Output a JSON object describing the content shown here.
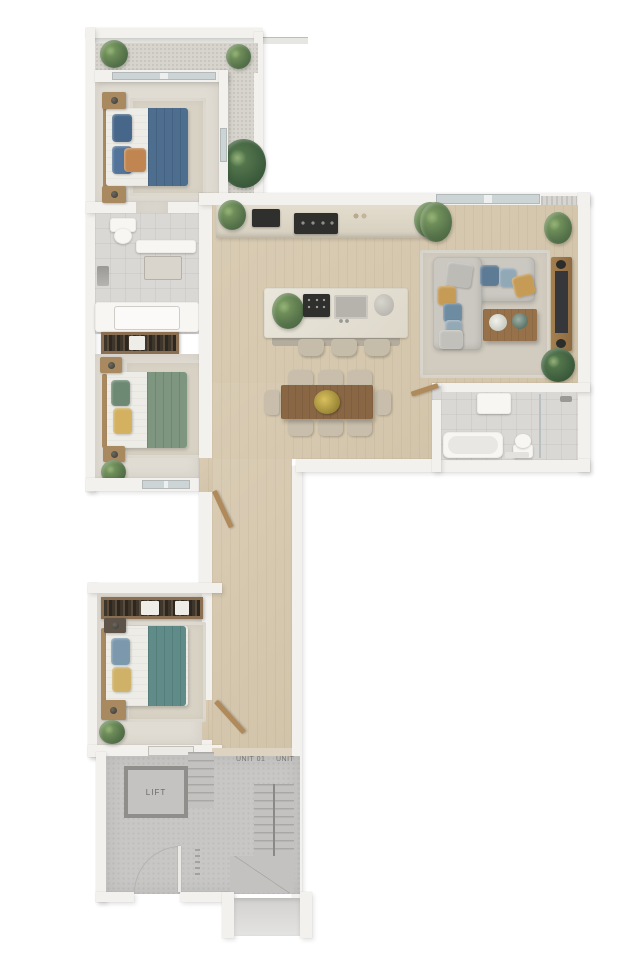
{
  "labels": {
    "lift": "LIFT",
    "unit_left": "UNIT 01",
    "unit_right": "UNIT"
  },
  "colors": {
    "bg": "#ffffff",
    "wall": "#f3f1ed",
    "wood_dark": "#8a6744",
    "sofa": "#cbc8c2",
    "fixture_white": "#f7f6f3",
    "bed_blue": "#4d6e8e",
    "bed_green": "#7e957f",
    "bed_teal": "#5f8b88",
    "pillow_mustard": "#c59b56",
    "pillow_blue": "#5d7b94",
    "appliance_dark": "#2f2f2d",
    "tv_black": "#35373a",
    "label_text": "#76756f"
  }
}
